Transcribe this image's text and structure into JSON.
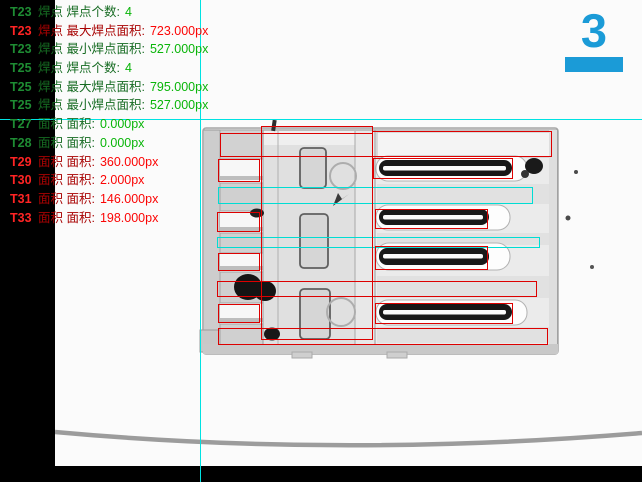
{
  "results_panel": {
    "lines": [
      {
        "tool": "T23",
        "label": "焊点 焊点个数:",
        "value": "4",
        "status": "pass"
      },
      {
        "tool": "T23",
        "label": "焊点 最大焊点面积:",
        "value": "723.000px",
        "status": "fail"
      },
      {
        "tool": "T23",
        "label": "焊点 最小焊点面积:",
        "value": "527.000px",
        "status": "pass"
      },
      {
        "tool": "T25",
        "label": "焊点 焊点个数:",
        "value": "4",
        "status": "pass"
      },
      {
        "tool": "T25",
        "label": "焊点 最大焊点面积:",
        "value": "795.000px",
        "status": "pass"
      },
      {
        "tool": "T25",
        "label": "焊点 最小焊点面积:",
        "value": "527.000px",
        "status": "pass"
      },
      {
        "tool": "T27",
        "label": "面积 面积:",
        "value": "0.000px",
        "status": "pass"
      },
      {
        "tool": "T28",
        "label": "面积 面积:",
        "value": "0.000px",
        "status": "pass"
      },
      {
        "tool": "T29",
        "label": "面积 面积:",
        "value": "360.000px",
        "status": "fail"
      },
      {
        "tool": "T30",
        "label": "面积 面积:",
        "value": "2.000px",
        "status": "fail"
      },
      {
        "tool": "T31",
        "label": "面积 面积:",
        "value": "146.000px",
        "status": "fail"
      },
      {
        "tool": "T33",
        "label": "面积 面积:",
        "value": "198.000px",
        "status": "fail"
      }
    ]
  },
  "indicator": {
    "value": "3"
  },
  "crosshair": {
    "x": 200,
    "y": 119
  },
  "colors": {
    "pass_tool": "#1e8c33",
    "pass_label": "#166b22",
    "pass_value": "#09b509",
    "fail_tool": "#ff2424",
    "fail_label": "#a80202",
    "fail_value": "#fb0505",
    "roi_red": "#dd0000",
    "roi_cyan": "#00ddd4",
    "crosshair_cyan": "#00e2e2",
    "accent_blue": "#1b9bd7"
  },
  "annotations": {
    "red_boxes": [
      [
        261,
        126,
        112,
        214
      ],
      [
        220,
        133,
        153,
        24
      ],
      [
        372,
        131,
        180,
        26
      ],
      [
        218,
        159,
        42,
        23
      ],
      [
        217,
        212,
        43,
        20
      ],
      [
        218,
        253,
        42,
        18
      ],
      [
        218,
        304,
        42,
        19
      ],
      [
        217,
        281,
        320,
        16
      ],
      [
        218,
        328,
        330,
        17
      ],
      [
        373,
        158,
        140,
        21
      ],
      [
        375,
        209,
        113,
        20
      ],
      [
        375,
        246,
        113,
        24
      ],
      [
        375,
        303,
        138,
        21
      ]
    ],
    "cyan_boxes": [
      [
        218,
        187,
        315,
        17
      ],
      [
        217,
        237,
        323,
        11
      ]
    ]
  }
}
